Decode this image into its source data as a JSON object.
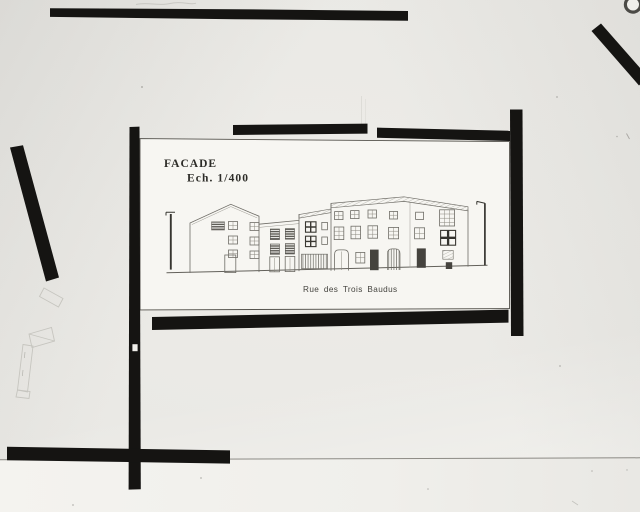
{
  "figure": {
    "title_block": {
      "line1": "FACADE",
      "line2": "Ech. 1/400"
    },
    "caption": "Rue des Trois Baudus"
  },
  "palette": {
    "board_background": "#e9e8e4",
    "board_lower_strip": "#f3f2ee",
    "tape_black": "#151412",
    "sheet_white": "#f7f6f2",
    "pencil_line": "#6f6d67",
    "title_ink": "#2d2c28",
    "caption_ink": "#44433e"
  }
}
